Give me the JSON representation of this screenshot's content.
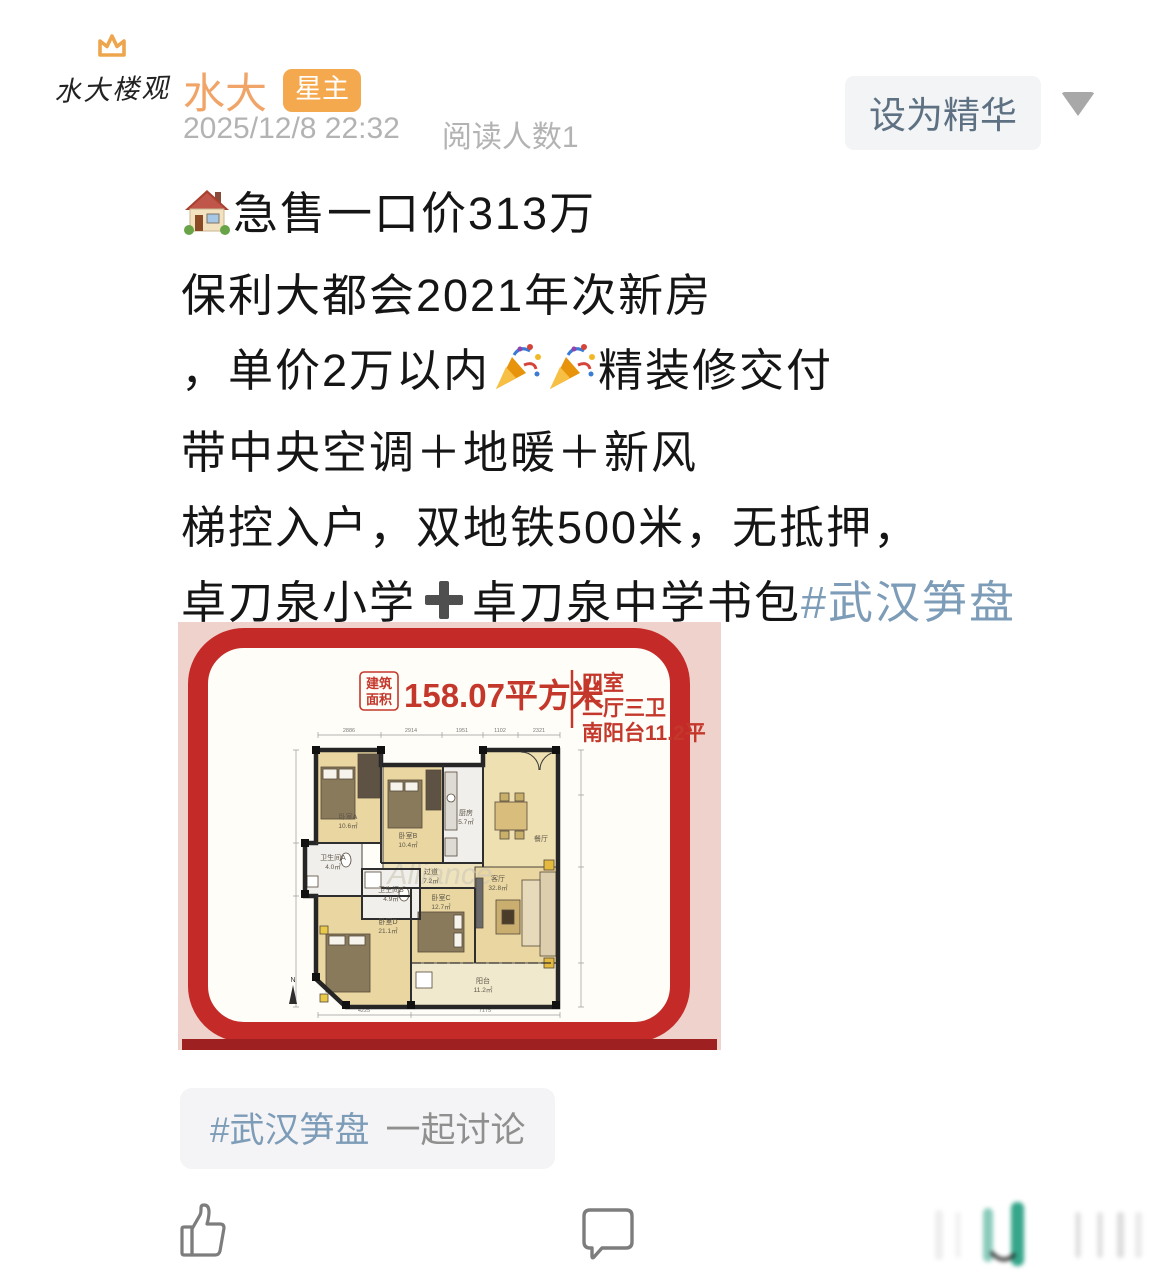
{
  "header": {
    "avatar_text": "水大楼观",
    "author": "水大",
    "badge": "星主",
    "date": "2025/12/8 22:32",
    "reads": "阅读人数1",
    "essence_button": "设为精华"
  },
  "content": {
    "l1_text": "急售一口价313万",
    "l2": "保利大都会2021年次新房",
    "l3_pre": "，单价2万以内",
    "l3_post": "精装修交付",
    "l4": "带中央空调＋地暖＋新风",
    "l5": "梯控入户，双地铁500米，无抵押，",
    "l6_a": "卓刀泉小学",
    "l6_b": "卓刀泉中学书包",
    "l6_hashtag": "#武汉笋盘"
  },
  "tag_pill": {
    "hashtag": "#武汉笋盘",
    "suffix": "一起讨论"
  },
  "floorplan": {
    "area_label_1": "建筑",
    "area_label_2": "面积",
    "area_value": "158.07平方米",
    "summary_1": "四室",
    "summary_2": "二厅三卫",
    "summary_3": "南阳台11.2平",
    "dims_top": [
      "2886",
      "2914",
      "1951",
      "1102",
      "2321"
    ],
    "dims_bottom": [
      "4225",
      "7175"
    ],
    "watermark": "Alliance",
    "north": "N",
    "rooms": [
      {
        "name": "卧室A",
        "area": "10.6㎡"
      },
      {
        "name": "卫生间A",
        "area": "4.0㎡"
      },
      {
        "name": "卧室B",
        "area": "10.4㎡"
      },
      {
        "name": "厨房",
        "area": "5.7㎡"
      },
      {
        "name": "餐厅",
        "area": ""
      },
      {
        "name": "过道",
        "area": "7.2㎡"
      },
      {
        "name": "客厅",
        "area": "32.8㎡"
      },
      {
        "name": "卫生间B",
        "area": "4.9㎡"
      },
      {
        "name": "卧室C",
        "area": "12.7㎡"
      },
      {
        "name": "卧室D",
        "area": "21.1㎡"
      },
      {
        "name": "阳台",
        "area": "11.2㎡"
      }
    ]
  },
  "colors": {
    "accent_orange": "#f5a94e",
    "hashtag_blue": "#7d9cb8",
    "frame_red": "#c42b28",
    "plan_red_text": "#c4372b",
    "meta_gray": "#b3b3b3"
  }
}
